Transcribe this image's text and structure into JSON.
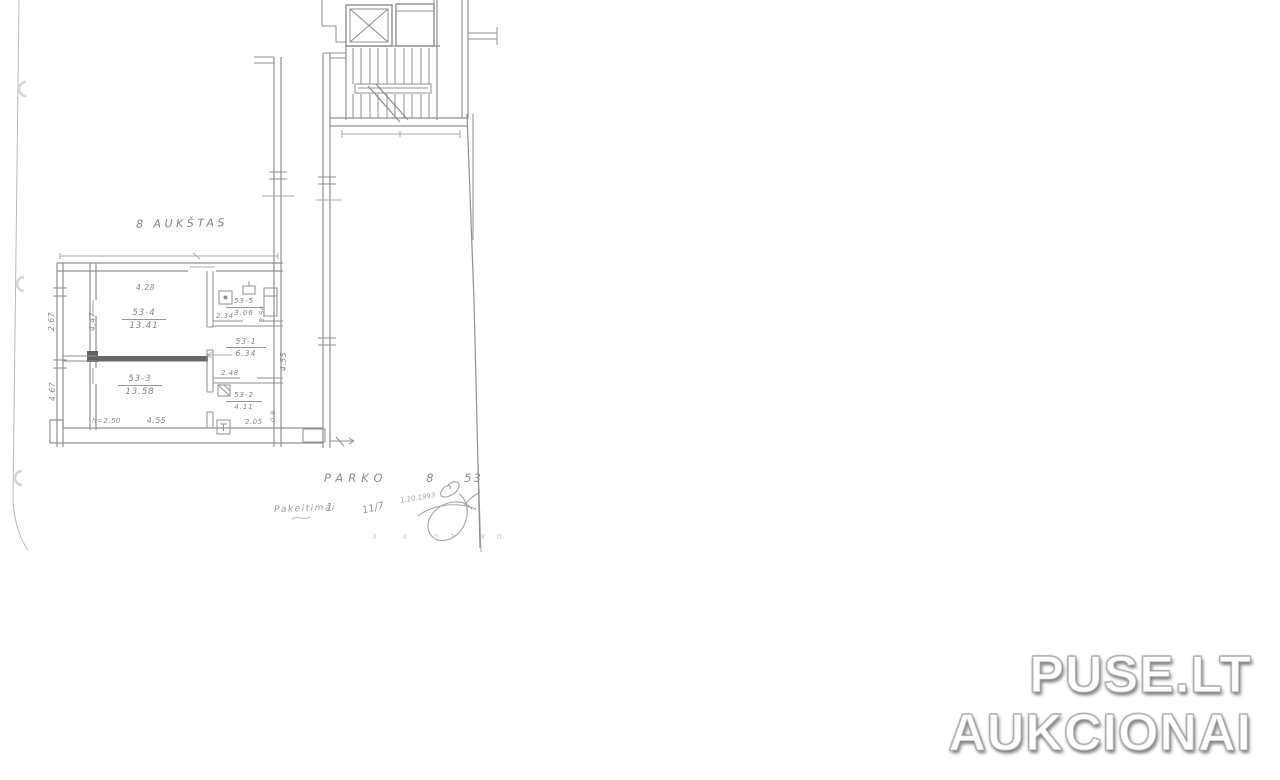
{
  "plan": {
    "title": "8 AUKŠTAS",
    "rooms": [
      {
        "id": "53-4",
        "area": "13.41"
      },
      {
        "id": "53-3",
        "area": "13.58"
      },
      {
        "id": "53-5",
        "area": "3.06"
      },
      {
        "id": "53-1",
        "area": "6.34"
      },
      {
        "id": "53-2",
        "area": "4.11"
      }
    ],
    "dimensions": {
      "top_width": "4.28",
      "loggia_upper": "2.67",
      "loggia_lower": "4.67",
      "room_left_height": "4.47",
      "room53_5_width": "2.34",
      "vent_shaft": "3.54",
      "hall_right_height": "4.55",
      "above_53_2": "2.48",
      "bottom_53_2": "2.05",
      "right_53_2": "0.9",
      "ceiling_height_note": "h=2.50",
      "bottom_width": "4.55"
    },
    "address": {
      "street": "PARKO",
      "house": "8",
      "apartment": "53"
    },
    "notes": {
      "revision_label": "Pakeitimai",
      "revision_number": "1",
      "fraction": "11/7",
      "date": "1.10.1993",
      "footer_marks": "3 4 03 80"
    }
  },
  "watermark": {
    "line1": "PUSE.LT",
    "line2": "AUKCIONAI",
    "text_color": "#ffffff",
    "shadow_color": "#8e8e93"
  },
  "scan": {
    "line_color": "#8a8a90",
    "background": "#ffffff"
  }
}
